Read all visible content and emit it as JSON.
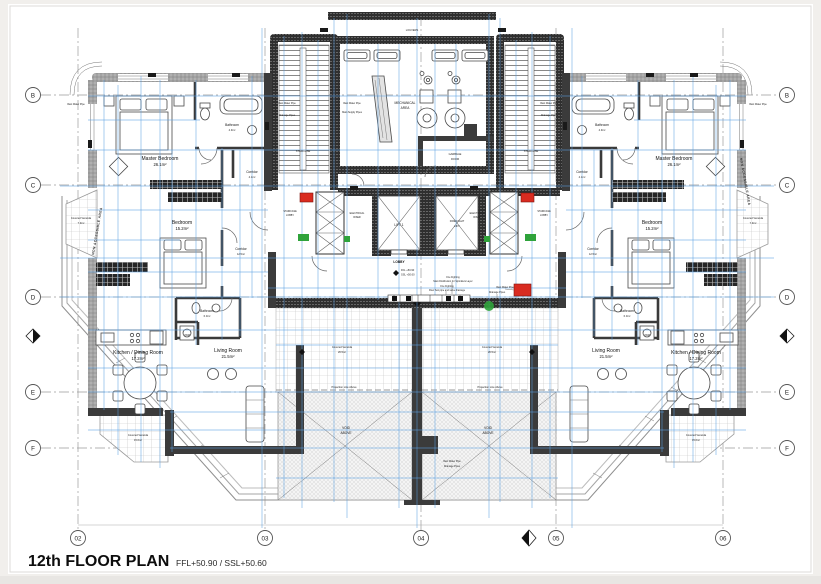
{
  "sheet": {
    "title": "12th FLOOR PLAN",
    "levels": "FFL+50.90 / SSL+50.60"
  },
  "grid": {
    "rows": [
      "B",
      "C",
      "D",
      "E",
      "F"
    ],
    "cols": [
      "02",
      "03",
      "04",
      "05",
      "06"
    ]
  },
  "rooms": {
    "master_bedroom": {
      "label": "Master Bedroom",
      "area": "26.1m²"
    },
    "bathroom_master": {
      "label": "Bathroom",
      "area": "4.9m²"
    },
    "corridor_upper": {
      "label": "Corridor",
      "area": "4.1m²"
    },
    "bedroom": {
      "label": "Bedroom",
      "area": "15.2m²"
    },
    "corridor_main": {
      "label": "Corridor",
      "area": "12.5m²"
    },
    "bathroom_main": {
      "label": "Bathroom",
      "area": "6.0m²"
    },
    "kitchen_dining": {
      "label": "Kitchen / Dining Room",
      "area": "17.2m²"
    },
    "living_room": {
      "label": "Living Room",
      "area": "21.5m²"
    },
    "veranda_side": {
      "label": "Covered Veranda",
      "area": "7.9m²"
    },
    "veranda_lower": {
      "label": "Covered Veranda",
      "area": "15.6m²"
    },
    "veranda_front": {
      "label": "Covered Veranda",
      "area": "26.5m²"
    },
    "laundry": {
      "label": "JWM"
    }
  },
  "core": {
    "louvers": "LOUVERS",
    "mech_line1": "MECHANICAL",
    "mech_line2": "AREA",
    "garbage_line1": "GARBAGE",
    "garbage_line2": "ROOM",
    "staircase": "STAIRCASE",
    "stair_lobby_line1": "STAIRCASE",
    "stair_lobby_line2": "LOBBY",
    "riser_line1": "ELECTRICAL",
    "riser_line2": "RISER",
    "lift_1": "LIFT 1",
    "lift_2_line1": "FIRE FIGHT",
    "lift_2_line2": "LIFT",
    "lobby": "LOBBY",
    "lobby_ffl": "FFL +50.90",
    "lobby_ssl": "SSL +50.60"
  },
  "notes": {
    "rain_water_pipe": "Rain Water Pipe",
    "drainage_pipes": "Drainage Pipes",
    "main_supply_pipes": "Main Supply Pipes",
    "fire_sprinkler_line1": "Fire Fighting",
    "fire_sprinkler_line2": "Main Distribution for Sprinklers Layer",
    "fire_flowtest_line1": "Fire Fighting",
    "fire_flowtest_line2": "Flow Test pipe and valve drainage",
    "projection_line": "Projection Line Above",
    "void_line1": "VOID",
    "void_line2": "ABOVE",
    "non_accessible": "NON ACCESSIBLE AREA"
  }
}
